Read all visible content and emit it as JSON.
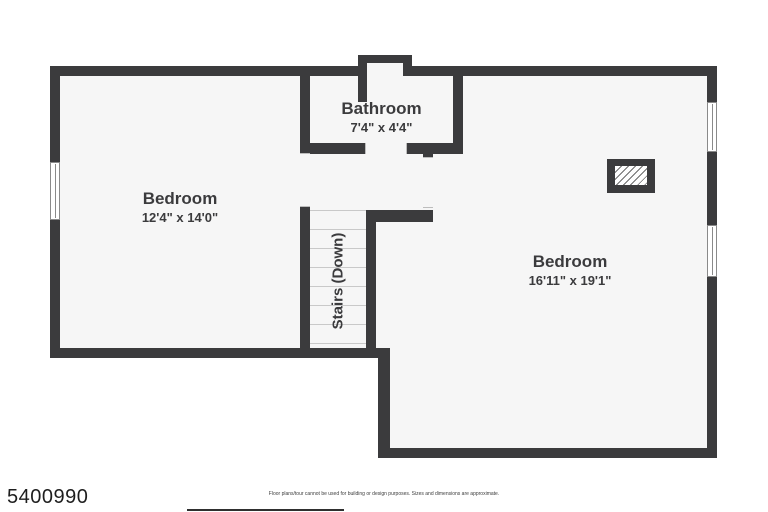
{
  "colors": {
    "wall": "#3b3b3d",
    "room_fill": "#f6f6f6",
    "window_line": "#8a8a8a",
    "tread": "#c9c9c9",
    "label_text": "#3b3b3d",
    "id_text": "#1e1e1e",
    "disclaimer_text": "#3c3c3c"
  },
  "plan": {
    "rooms": [
      {
        "name": "Bedroom",
        "dims": "12'4\" x 14'0\""
      },
      {
        "name": "Bathroom",
        "dims": "7'4\" x 4'4\""
      },
      {
        "name": "Bedroom",
        "dims": "16'11\" x 19'1\""
      }
    ],
    "stairs": {
      "label": "Stairs (Down)"
    }
  },
  "footer": {
    "listing_id": "5400990",
    "disclaimer": "Floor plans/tour cannot be used for building or design purposes. Sizes and dimensions are approximate."
  }
}
